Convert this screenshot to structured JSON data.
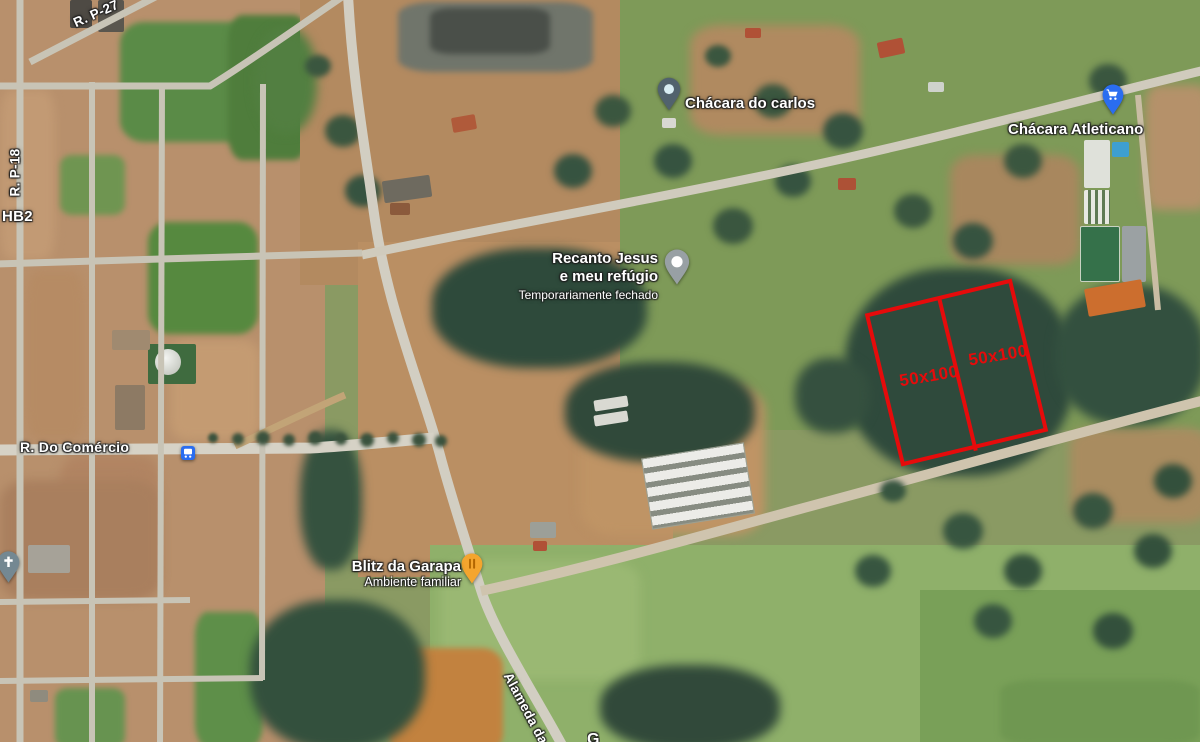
{
  "map": {
    "road_labels": {
      "p27": "R. P-27",
      "p18": "R. P-18",
      "hb2": "HB2",
      "comercio": "R. Do Comércio",
      "alameda": "Alameda da",
      "partial_bottom": "G"
    },
    "places": {
      "carlos": {
        "name": "Chácara do carlos"
      },
      "atleticano": {
        "name": "Chácara Atleticano"
      },
      "recanto": {
        "line1": "Recanto Jesus",
        "line2": "e meu refúgio",
        "status": "Temporariamente fechado"
      },
      "blitz": {
        "name": "Blitz da Garapa",
        "subtitle": "Ambiente familiar"
      }
    },
    "annotation": {
      "plot1_label": "50x100",
      "plot2_label": "50x100",
      "color": "#e60b0b"
    },
    "colors": {
      "pin_slate": "#51626d",
      "pin_slate_dot": "#d8edf3",
      "pin_blue": "#2a6df0",
      "pin_gray": "#98a0a4",
      "pin_orange": "#f4a52e",
      "pin_church": "#74889 2",
      "bus_blue": "#2a6df0"
    }
  }
}
